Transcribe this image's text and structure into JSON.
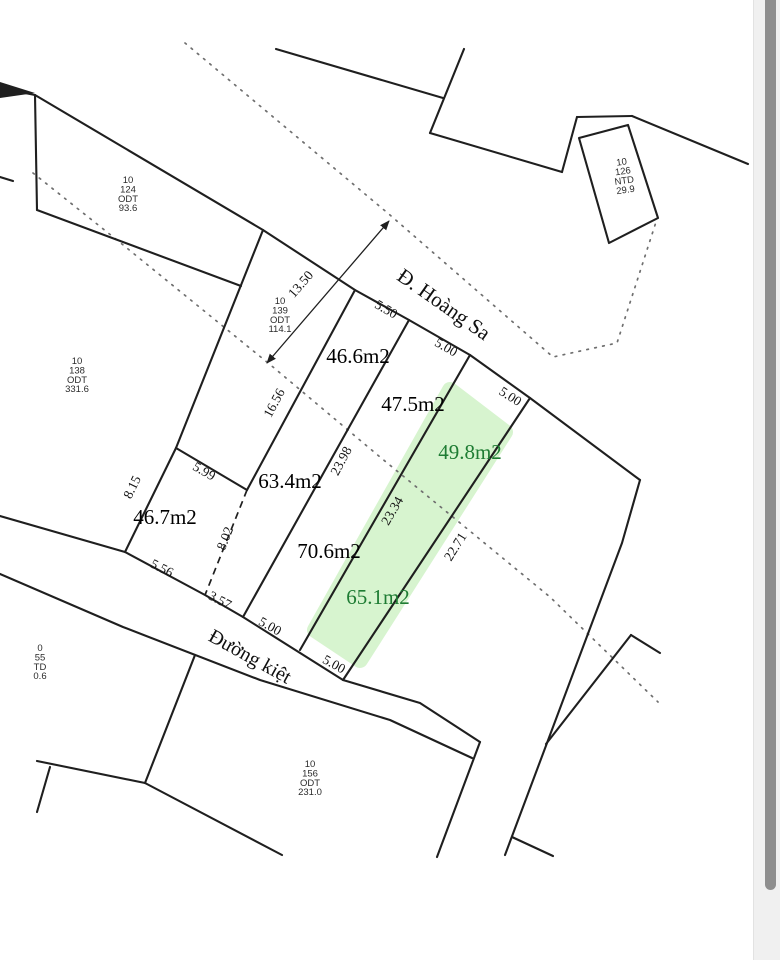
{
  "map": {
    "line_color": "#1f1f1f",
    "dotted_color": "#6f6f6f",
    "highlight": {
      "fill": "#d7f4cf",
      "points": [
        [
          450,
          390
        ],
        [
          505,
          432
        ],
        [
          360,
          660
        ],
        [
          315,
          630
        ]
      ]
    },
    "wedges": [
      [
        [
          0,
          82
        ],
        [
          35,
          93
        ],
        [
          0,
          98
        ]
      ]
    ],
    "solid_lines": [
      [
        [
          0,
          88
        ],
        [
          35,
          95
        ]
      ],
      [
        [
          35,
          95
        ],
        [
          263,
          230
        ],
        [
          355,
          290
        ],
        [
          409,
          320
        ],
        [
          470,
          355
        ],
        [
          530,
          398
        ],
        [
          640,
          480
        ]
      ],
      [
        [
          35,
          95
        ],
        [
          37,
          210
        ]
      ],
      [
        [
          37,
          210
        ],
        [
          241,
          286
        ]
      ],
      [
        [
          263,
          230
        ],
        [
          176,
          448
        ]
      ],
      [
        [
          276,
          49
        ],
        [
          443,
          98
        ]
      ],
      [
        [
          464,
          49
        ],
        [
          430,
          133
        ]
      ],
      [
        [
          430,
          133
        ],
        [
          562,
          172
        ]
      ],
      [
        [
          562,
          172
        ],
        [
          577,
          117
        ]
      ],
      [
        [
          577,
          117
        ],
        [
          632,
          116
        ]
      ],
      [
        [
          632,
          116
        ],
        [
          748,
          164
        ]
      ],
      [
        [
          579,
          138
        ],
        [
          628,
          125
        ],
        [
          658,
          218
        ],
        [
          609,
          243
        ],
        [
          579,
          138
        ]
      ],
      [
        [
          355,
          290
        ],
        [
          247,
          490
        ]
      ],
      [
        [
          409,
          320
        ],
        [
          243,
          617
        ]
      ],
      [
        [
          470,
          355
        ],
        [
          300,
          650
        ]
      ],
      [
        [
          530,
          398
        ],
        [
          343,
          680
        ]
      ],
      [
        [
          176,
          448
        ],
        [
          247,
          490
        ]
      ],
      [
        [
          176,
          448
        ],
        [
          125,
          552
        ]
      ],
      [
        [
          0,
          516
        ],
        [
          125,
          552
        ],
        [
          205,
          595
        ],
        [
          243,
          617
        ],
        [
          343,
          680
        ],
        [
          420,
          703
        ],
        [
          480,
          742
        ]
      ],
      [
        [
          0,
          574
        ],
        [
          123,
          627
        ],
        [
          260,
          680
        ],
        [
          390,
          720
        ],
        [
          472,
          758
        ]
      ],
      [
        [
          640,
          480
        ],
        [
          622,
          543
        ],
        [
          505,
          855
        ]
      ],
      [
        [
          512,
          837
        ],
        [
          553,
          856
        ]
      ],
      [
        [
          480,
          742
        ],
        [
          437,
          857
        ]
      ],
      [
        [
          631,
          635
        ],
        [
          546,
          744
        ]
      ],
      [
        [
          631,
          635
        ],
        [
          660,
          653
        ]
      ],
      [
        [
          195,
          655
        ],
        [
          145,
          783
        ]
      ],
      [
        [
          37,
          761
        ],
        [
          145,
          783
        ]
      ],
      [
        [
          145,
          783
        ],
        [
          282,
          855
        ]
      ],
      [
        [
          50,
          767
        ],
        [
          37,
          812
        ]
      ],
      [
        [
          0,
          177
        ],
        [
          13,
          181
        ]
      ]
    ],
    "dashed_lines": [
      [
        [
          247,
          490
        ],
        [
          205,
          595
        ]
      ]
    ],
    "dotted_lines": [
      [
        [
          185,
          43
        ],
        [
          390,
          215
        ],
        [
          553,
          357
        ],
        [
          617,
          343
        ],
        [
          656,
          222
        ]
      ],
      [
        [
          33,
          173
        ],
        [
          117,
          240
        ],
        [
          273,
          367
        ],
        [
          380,
          457
        ],
        [
          550,
          597
        ],
        [
          658,
          702
        ]
      ]
    ],
    "arrows": [
      {
        "from": [
          267,
          363
        ],
        "to": [
          389,
          221
        ]
      }
    ],
    "streets": [
      {
        "name": "Đ. Hoàng Sa",
        "x": 440,
        "y": 310,
        "rotate": 35,
        "size": 21
      },
      {
        "name": "Đường kiệt",
        "x": 247,
        "y": 662,
        "rotate": 29,
        "size": 20
      }
    ],
    "area_labels": [
      {
        "t": "46.6m2",
        "x": 358,
        "y": 363,
        "c": "#000000"
      },
      {
        "t": "47.5m2",
        "x": 413,
        "y": 411,
        "c": "#000000"
      },
      {
        "t": "49.8m2",
        "x": 470,
        "y": 459,
        "c": "#1e7c33"
      },
      {
        "t": "63.4m2",
        "x": 290,
        "y": 488,
        "c": "#000000"
      },
      {
        "t": "46.7m2",
        "x": 165,
        "y": 524,
        "c": "#000000"
      },
      {
        "t": "70.6m2",
        "x": 329,
        "y": 558,
        "c": "#000000"
      },
      {
        "t": "65.1m2",
        "x": 378,
        "y": 604,
        "c": "#1e7c33"
      }
    ],
    "measurements": [
      {
        "v": "13.50",
        "x": 304,
        "y": 287,
        "r": -49
      },
      {
        "v": "5.50",
        "x": 384,
        "y": 313,
        "r": 30
      },
      {
        "v": "5.00",
        "x": 444,
        "y": 351,
        "r": 30
      },
      {
        "v": "5.00",
        "x": 508,
        "y": 400,
        "r": 33
      },
      {
        "v": "16.56",
        "x": 278,
        "y": 405,
        "r": -62
      },
      {
        "v": "23.98",
        "x": 345,
        "y": 463,
        "r": -62
      },
      {
        "v": "23.34",
        "x": 396,
        "y": 513,
        "r": -60
      },
      {
        "v": "22.71",
        "x": 459,
        "y": 549,
        "r": -58
      },
      {
        "v": "8.15",
        "x": 136,
        "y": 489,
        "r": -64
      },
      {
        "v": "5.99",
        "x": 202,
        "y": 475,
        "r": 30
      },
      {
        "v": "8.02",
        "x": 229,
        "y": 540,
        "r": -68
      },
      {
        "v": "5.56",
        "x": 160,
        "y": 572,
        "r": 27
      },
      {
        "v": "3.57",
        "x": 218,
        "y": 604,
        "r": 28
      },
      {
        "v": "5.00",
        "x": 268,
        "y": 630,
        "r": 29
      },
      {
        "v": "5.00",
        "x": 332,
        "y": 668,
        "r": 29
      }
    ],
    "parcel_ids": [
      {
        "lines": [
          "10",
          "124",
          "ODT",
          "93.6"
        ],
        "x": 128,
        "y": 183,
        "rotate": 0
      },
      {
        "lines": [
          "10",
          "139",
          "ODT",
          "114.1"
        ],
        "x": 280,
        "y": 304,
        "rotate": 0
      },
      {
        "lines": [
          "10",
          "138",
          "ODT",
          "331.6"
        ],
        "x": 77,
        "y": 364,
        "rotate": 0
      },
      {
        "lines": [
          "10",
          "126",
          "NTD",
          "29.9"
        ],
        "x": 622,
        "y": 165,
        "rotate": -8
      },
      {
        "lines": [
          "10",
          "156",
          "ODT",
          "231.0"
        ],
        "x": 310,
        "y": 767,
        "rotate": 0
      },
      {
        "lines": [
          "0",
          "55",
          "TD",
          "0.6"
        ],
        "x": 40,
        "y": 651,
        "rotate": 0
      }
    ]
  },
  "scrollbar": {
    "track_color": "#f0f0f0",
    "thumb_color": "#8e8e8e"
  }
}
